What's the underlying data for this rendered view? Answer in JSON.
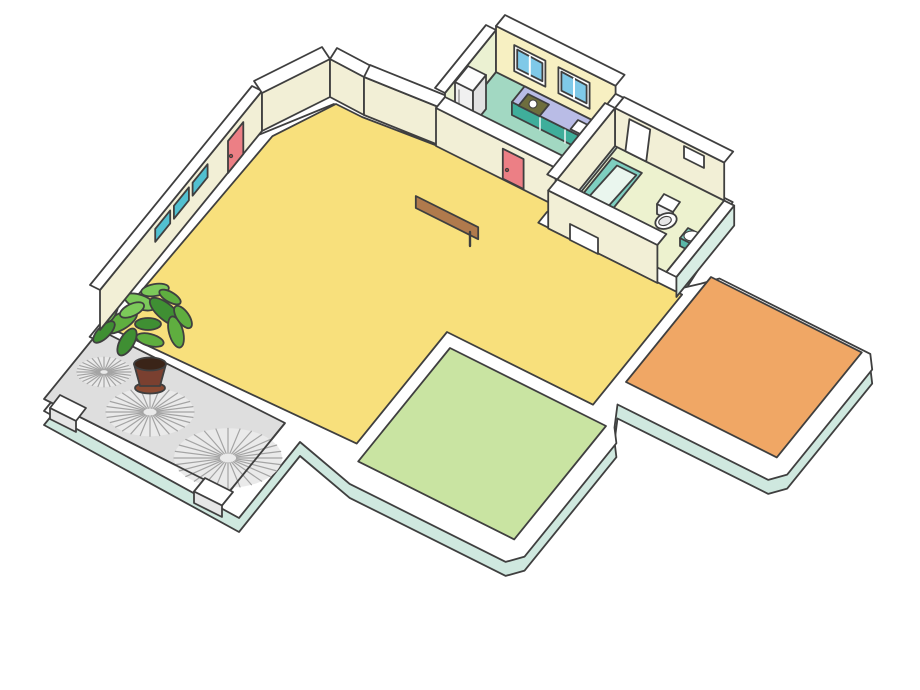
{
  "scene": {
    "title": "isometric-cutaway-apartment-floor-plan",
    "width": 920,
    "height": 690,
    "background": "#ffffff"
  },
  "palette": {
    "outline": "#3f3f3f",
    "wallWhite": "#ffffff",
    "skirtMint": "#cfe8df",
    "faceMint": "#d8ede4",
    "faceCream": "#f2efd6",
    "facePaleYellow": "#f7f0c2",
    "facePaleGreen": "#ebf1d2",
    "floorYellow": "#f8e07c",
    "floorKitchen": "#a2d8c2",
    "floorBath": "#edf2cf",
    "floorBedroom": "#f0a765",
    "floorKids": "#c9e4a2",
    "floorBalcony": "#dedede",
    "windowBlue": "#7fc9e8",
    "doorRed": "#ec7f85",
    "doorRedDark": "#b04848",
    "counterTop": "#b9bce6",
    "counterFront": "#3fae9b",
    "stoveOlive": "#6e6e3e",
    "tubTeal": "#7ecfc0",
    "tubInner": "#eaf6ee",
    "sofaMain": "#f2a08e",
    "sofaLight": "#f6bca9",
    "sofaDark": "#e05f70",
    "cushionPurple": "#8f86c8",
    "rugGray": "#dcdcdc",
    "rugDot": "#b5b5b5",
    "woodLight": "#d9a06a",
    "woodMid": "#cf8a4a",
    "woodDark": "#b07a4c",
    "stoolTeal": "#3fbdbd",
    "frameTeal": "#52c0d0",
    "bedMagenta": "#c673bb",
    "bedDot": "#e8a8d8",
    "pillowPink": "#d873b8",
    "padYellow": "#ece87a",
    "closetGreen": "#aed45c",
    "dresserBrown": "#c28a5a",
    "chestPurple": "#8f86c8",
    "chestBlue": "#6aa8d8",
    "rugBeige": "#eddac5",
    "wallPink": "#f6c0d8",
    "kidsBedBlue": "#6aa6d4",
    "kidsBedBlueLight": "#92c4e4",
    "kidsPillow": "#dde48a",
    "wardrobeBlue": "#3b96d2",
    "wardrobeBlueDark": "#2a7fc0",
    "shelfInner": "#eef4f8",
    "deskOrange": "#ec9c5c",
    "deskOrangeDark": "#d9854a",
    "chairPurple": "#8f86c8",
    "chairPurpleDark": "#7a72b8",
    "basketball": "#d4703a",
    "lampWhite": "#ffffff",
    "slipperDark": "#5a3a34",
    "plantGreen1": "#5fae3f",
    "plantGreen2": "#7cc95a",
    "plantGreen3": "#3f8f33",
    "potBrown": "#7a4030",
    "potDark": "#3a2418",
    "swirlBase": "#eaeaea",
    "balconyTrimBlue": "#5ec8e8",
    "bookColors": [
      "#e05858",
      "#f0c040",
      "#58b058",
      "#7070d0",
      "#e080b8",
      "#40b8c8",
      "#e08840",
      "#a0c048",
      "#c05890"
    ]
  },
  "rooms": [
    {
      "id": "kitchen",
      "name": "Kitchen",
      "floor": "floorKitchen",
      "furniture": [
        "refrigerator",
        "counter",
        "stove",
        "sink",
        "window",
        "window",
        "red-door"
      ]
    },
    {
      "id": "bathroom",
      "name": "Bathroom",
      "floor": "floorBath",
      "furniture": [
        "bathtub",
        "toilet",
        "bidet-sink",
        "white-door",
        "wall-niche",
        "window-slot"
      ]
    },
    {
      "id": "hall",
      "name": "Hall / Dining",
      "floor": "floorYellow",
      "furniture": [
        "dining-table",
        "stool",
        "stool",
        "stool",
        "stool",
        "entry-door",
        "kitchen-door"
      ]
    },
    {
      "id": "living",
      "name": "Living room",
      "floor": "floorYellow",
      "furniture": [
        "l-shaped-sofa",
        "purple-cushion",
        "area-rug",
        "coffee-table",
        "wall-frame",
        "wall-frame",
        "wall-frame",
        "side-shelf"
      ]
    },
    {
      "id": "bedroom",
      "name": "Bedroom",
      "floor": "floorBedroom",
      "furniture": [
        "double-bed",
        "pillows",
        "foot-bench",
        "striped-closet",
        "dresser",
        "drawer-chest",
        "wall-shelf",
        "beige-rug",
        "slippers",
        "window-band",
        "red-door"
      ]
    },
    {
      "id": "kids",
      "name": "Kids room",
      "floor": "floorKids",
      "furniture": [
        "striped-bed",
        "pillows",
        "wardrobe-bookshelf",
        "books",
        "desk",
        "computer-monitor",
        "keyboard",
        "chair",
        "basketball",
        "nightstand",
        "nightstand",
        "lamp",
        "lamp",
        "slippers",
        "wall-shelf",
        "red-door"
      ]
    },
    {
      "id": "balcony",
      "name": "Balcony / patio",
      "floor": "floorBalcony",
      "furniture": [
        "potted-plant",
        "gravel-swirl",
        "gravel-swirl",
        "gravel-swirl",
        "planter-box",
        "planter-box",
        "blue-railing-trim"
      ]
    }
  ]
}
